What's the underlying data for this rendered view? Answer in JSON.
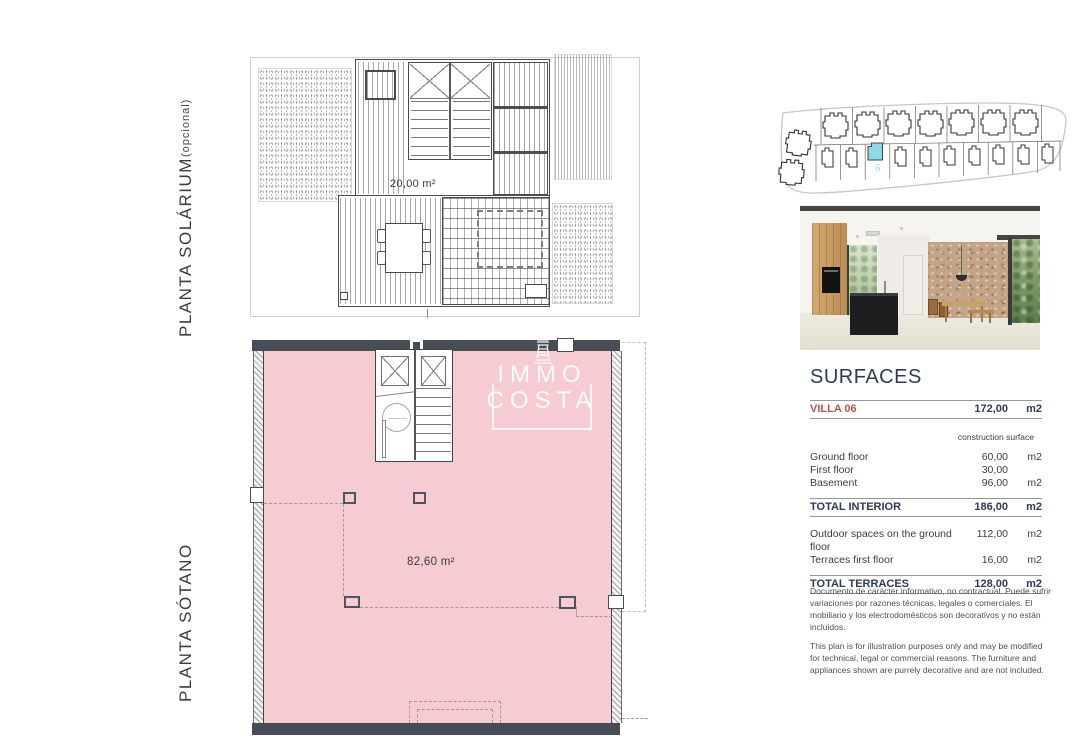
{
  "labels": {
    "solarium_title": "PLANTA SOLÁRIUM",
    "solarium_suffix": " (opcional)",
    "sotano_title": "PLANTA SÓTANO"
  },
  "solarium_plan": {
    "area": "20,00 m²"
  },
  "basement_plan": {
    "area": "82,60 m²"
  },
  "watermark": {
    "line1": "IMMO",
    "line2": "COSTA"
  },
  "site_plan": {
    "unit_number": "6"
  },
  "colors": {
    "basement_fill": "#f7cbd2",
    "wall_dark": "#474c57",
    "highlight_cyan": "#8ed9e6",
    "table_navy": "#2c3a5c",
    "villa_red": "#b0544f"
  },
  "surfaces": {
    "title": "SURFACES",
    "villa_row": {
      "name": "VILLA 06",
      "value": "172,00",
      "unit": "m2"
    },
    "col_header": "construction surface",
    "rows": [
      {
        "label": "Ground floor",
        "value": "60,00",
        "unit": "m2"
      },
      {
        "label": "First floor",
        "value": "30,00",
        "unit": ""
      },
      {
        "label": "Basement",
        "value": "96,00",
        "unit": "m2"
      }
    ],
    "total_interior": {
      "label": "TOTAL INTERIOR",
      "value": "186,00",
      "unit": "m2"
    },
    "outdoor_rows": [
      {
        "label": "Outdoor spaces on the ground floor",
        "value": "112,00",
        "unit": "m2"
      },
      {
        "label": "Terraces first floor",
        "value": "16,00",
        "unit": "m2"
      }
    ],
    "total_terraces": {
      "label": "TOTAL TERRACES",
      "value": "128,00",
      "unit": "m2"
    }
  },
  "disclaimer": {
    "es": "Documento de carácter informativo, no contractual. Puede sufrir variaciones por razones técnicas, legales o comerciales. El mobiliario y los electrodomésticos son decorativos y no están incluidos.",
    "en": "This plan is for illustration purposes only and may be modified for technical, legal or commercial reasons. The furniture and appliances shown are purrely decorative and are not included."
  }
}
